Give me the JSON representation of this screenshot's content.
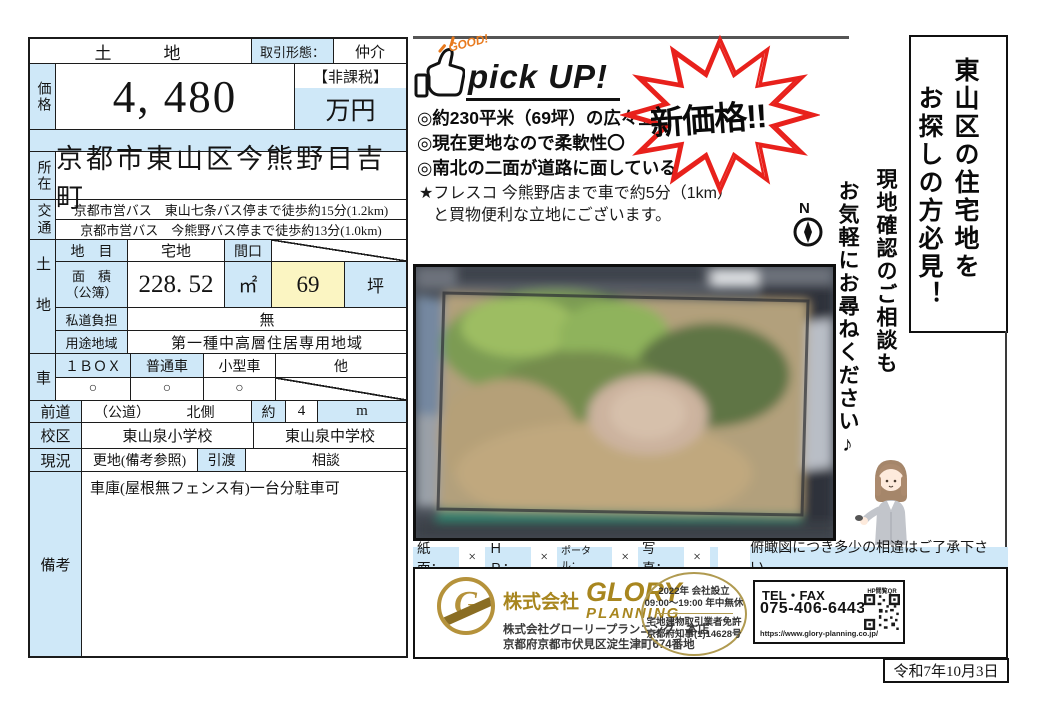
{
  "colors": {
    "cell_blue": "#cfe8f8",
    "cell_yellow": "#fbf5c2",
    "star_red": "#e8211c",
    "gold": "#a8861f",
    "orange": "#e87a1e"
  },
  "table": {
    "type": "土　　地",
    "deal_label": "取引形態：",
    "deal_value": "仲介",
    "price": {
      "label": "価格",
      "value": "4, 480",
      "tax_note": "【非課税】",
      "unit": "万円"
    },
    "location": {
      "label": "所在",
      "value": "京都市東山区今熊野日吉町"
    },
    "access": {
      "label": "交通",
      "lines": [
        "京都市営バス　東山七条バス停まで徒歩約15分(1.2km)",
        "京都市営バス　今熊野バス停まで徒歩約13分(1.0km)"
      ]
    },
    "land": {
      "label": "土地",
      "category_label": "地　目",
      "category_value": "宅地",
      "frontage_label": "間口",
      "area_label": "面　積",
      "area_sublabel": "（公簿）",
      "area_m2": "228. 52",
      "m2_unit": "㎡",
      "area_tsubo": "69",
      "tsubo_unit": "坪",
      "private_road_label": "私道負担",
      "private_road_value": "無",
      "zoning_label": "用途地域",
      "zoning_value": "第一種中高層住居専用地域"
    },
    "car": {
      "label": "車",
      "col1": "１ＢＯＸ",
      "col2": "普通車",
      "col3": "小型車",
      "col4": "他",
      "mark1": "○",
      "mark2": "○",
      "mark3": "○"
    },
    "road": {
      "label": "前道",
      "kind": "（公道）",
      "side": "北側",
      "approx": "約",
      "width": "4",
      "unit": "m"
    },
    "school": {
      "label": "校区",
      "elementary": "東山泉小学校",
      "junior_high": "東山泉中学校"
    },
    "status": {
      "label": "現況",
      "value": "更地(備考参照)",
      "handover_label": "引渡",
      "handover_value": "相談"
    },
    "remarks": {
      "label": "備考",
      "value": "車庫(屋根無フェンス有)一台分駐車可"
    }
  },
  "pickup": {
    "good": "GOOD!",
    "title": "pick UP!",
    "point1": "◎約230平米（69坪）の広々立地！",
    "point2": "◎現在更地なので柔軟性〇",
    "point3": "◎南北の二面が道路に面している！",
    "note1": "★フレスコ 今熊野店まで車で約5分（1km）",
    "note2": "と買物便利な立地にございます。",
    "new_price": "新価格!!"
  },
  "compass": {
    "north": "N"
  },
  "banner": {
    "line1": "東山区の住宅地を",
    "line2": "お探しの方必見！"
  },
  "consult": {
    "line1": "現地確認のご相談も",
    "line2": "お気軽にお尋ねください♪"
  },
  "disclaimer": {
    "items": [
      {
        "label": "紙面：",
        "mark": "×"
      },
      {
        "label": "ＨＰ：",
        "mark": "×"
      },
      {
        "label": "ポータル：",
        "mark": "×"
      },
      {
        "label": "写真：",
        "mark": "×"
      }
    ],
    "note": "俯瞰図につき多少の相違はご了承下さい。"
  },
  "company": {
    "prefix": "株式会社",
    "brand1": "GLORY",
    "brand2": "PLANNING",
    "name_line": "株式会社グローリープランニング　本店",
    "address_line": "京都府京都市伏見区淀生津町674番地",
    "oval_line1": "2022年 会社設立",
    "oval_line2": "09:00～19:00 年中無休",
    "oval_line3": "宅地建物取引業者免許",
    "oval_line4": "京都府知事(1)14628号",
    "tel_label": "TEL・FAX",
    "tel_number": "075-406-6443",
    "url": "https://www.glory-planning.co.jp/",
    "qr_label": "HP閲覧QR"
  },
  "date": "令和7年10月3日"
}
